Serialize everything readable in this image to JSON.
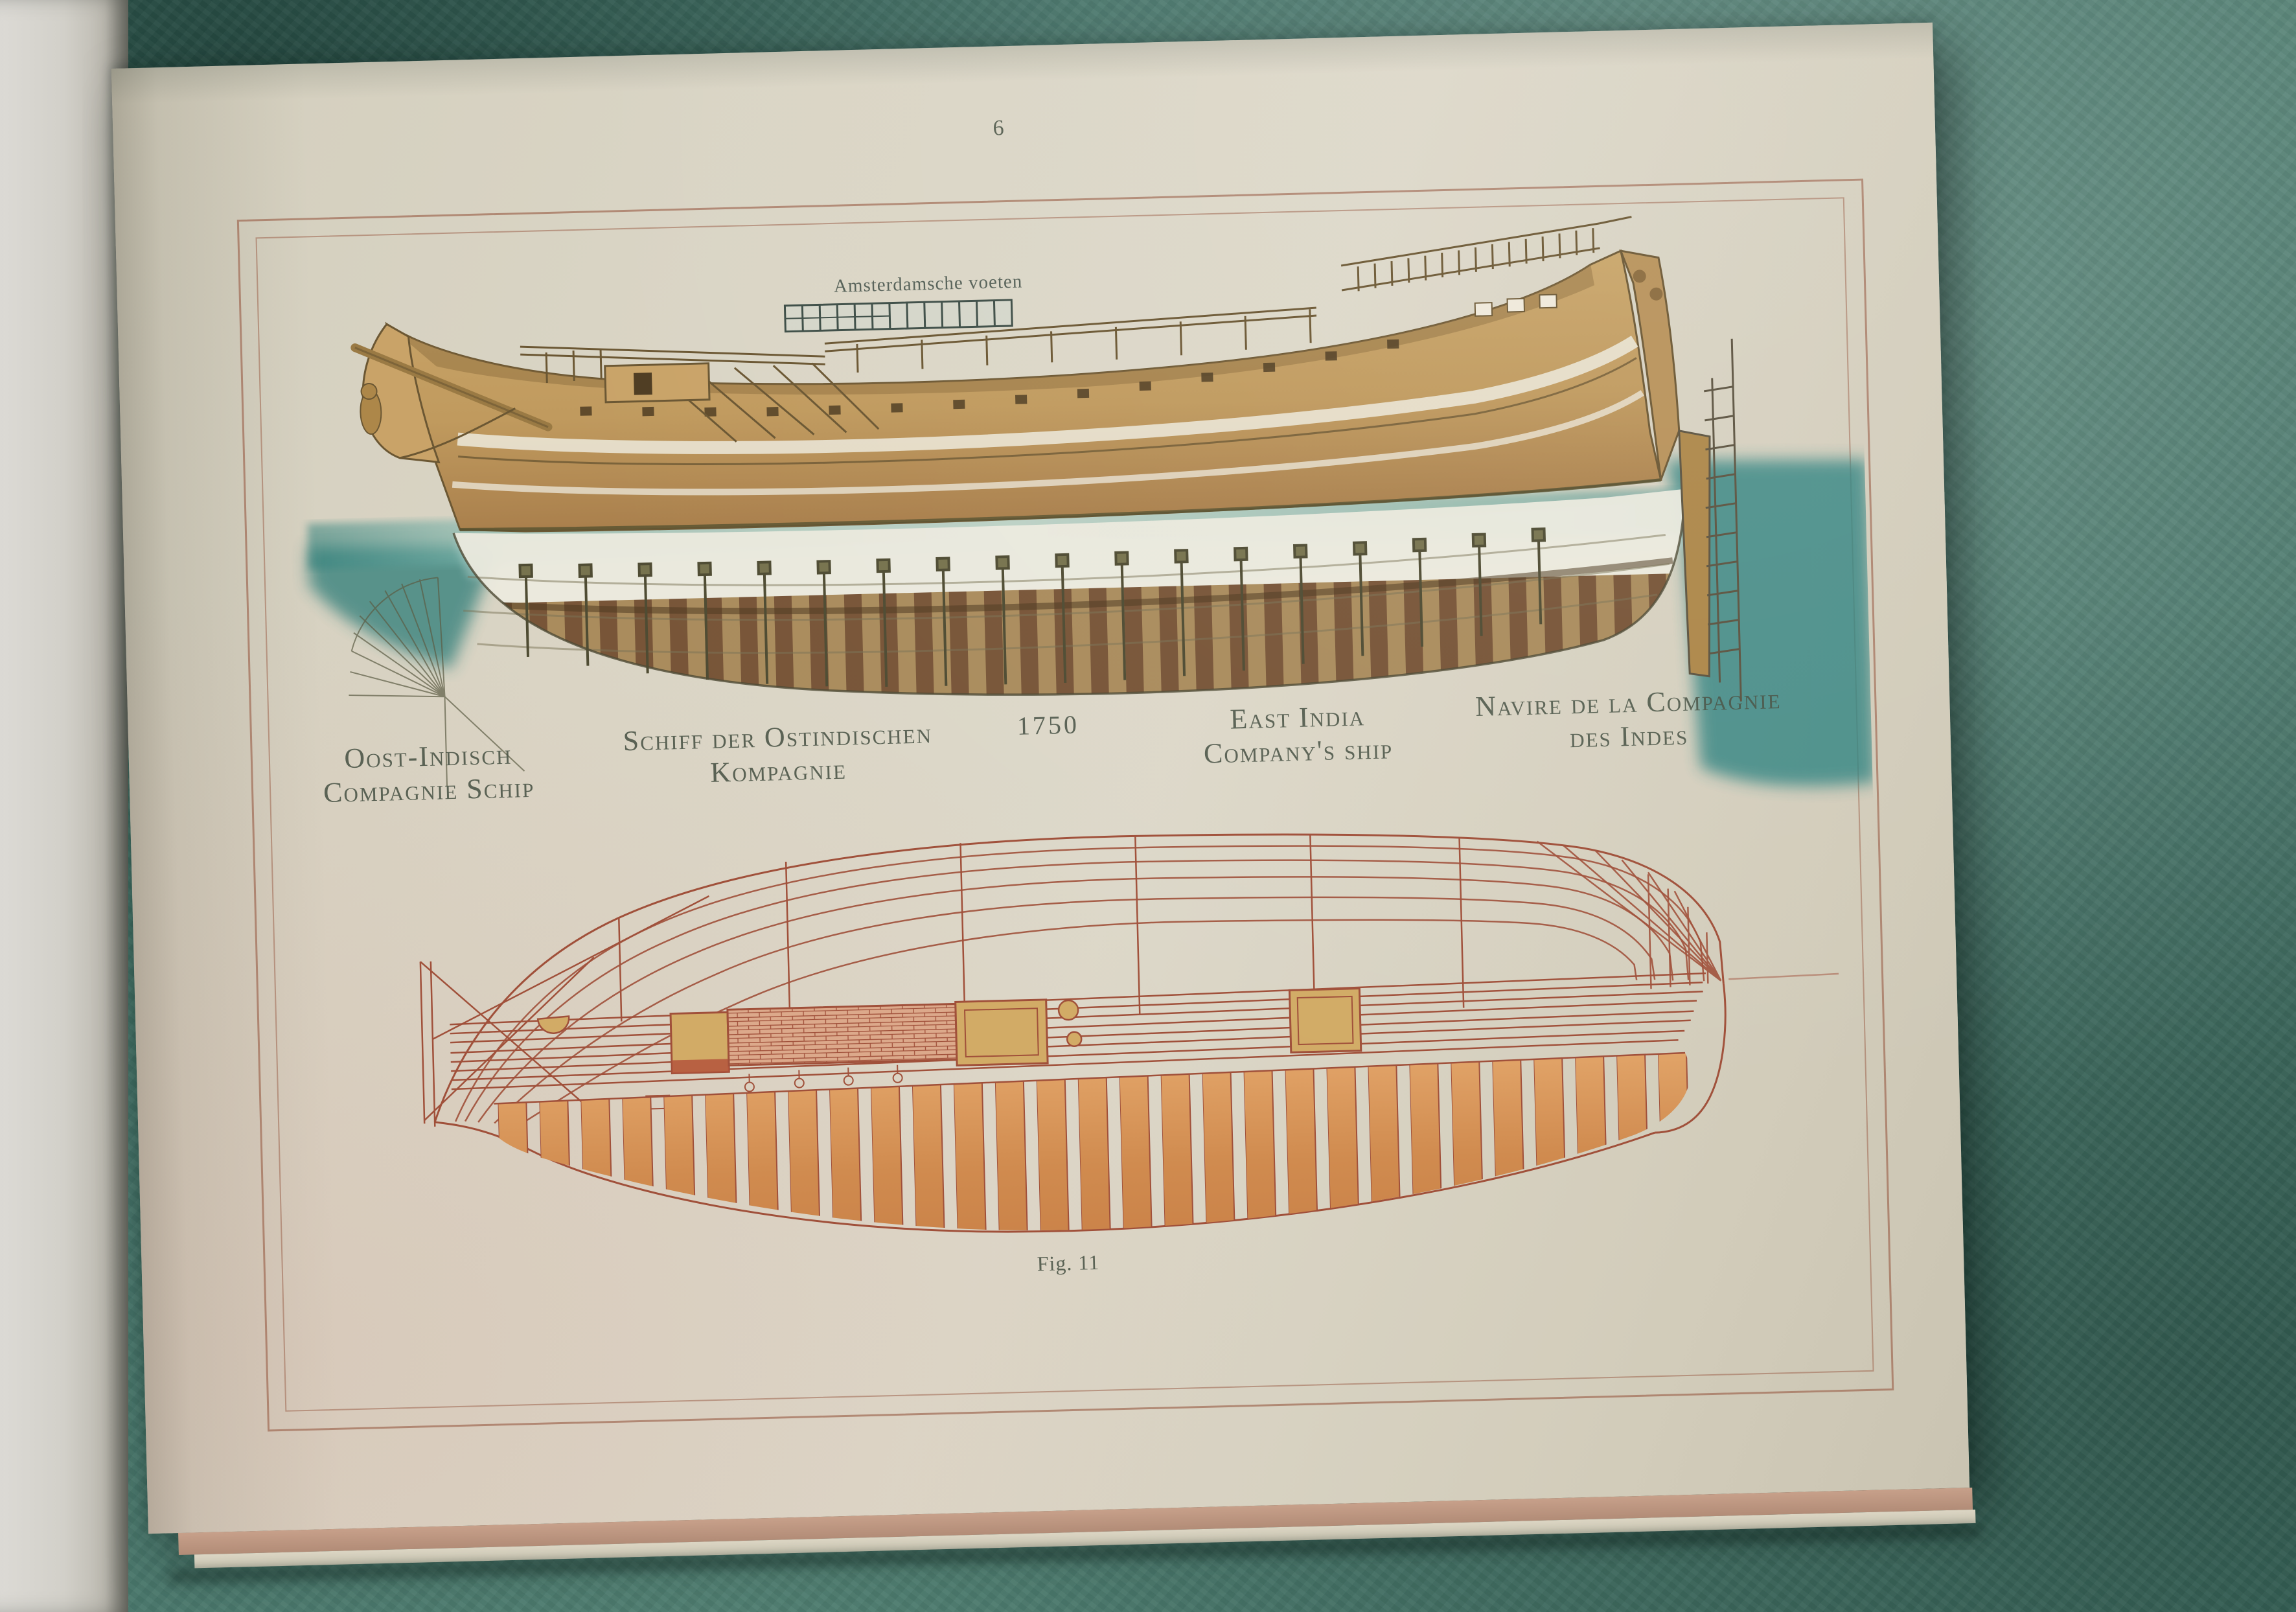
{
  "page": {
    "number": "6",
    "figure_caption": "Fig. 11"
  },
  "scale_bar": {
    "label": "Amsterdamsche voeten",
    "segments": 13
  },
  "captions": {
    "dutch_line1": "Oost-Indisch",
    "dutch_line2": "Compagnie Schip",
    "german_line1": "Schiff der Ostindischen",
    "german_line2": "Kompagnie",
    "year": "1750",
    "english_line1": "East India",
    "english_line2": "Company's ship",
    "french_line1": "Navire de la Compagnie",
    "french_line2": "des Indes"
  },
  "colors": {
    "table_teal": "#47756a",
    "page_cream": "#dad5c5",
    "frame_line": "#a16c56",
    "plan_line": "#a0503a",
    "hull_tan": "#c9a368",
    "water_teal": "#3f8a84",
    "caption_text": "#4b5244"
  }
}
